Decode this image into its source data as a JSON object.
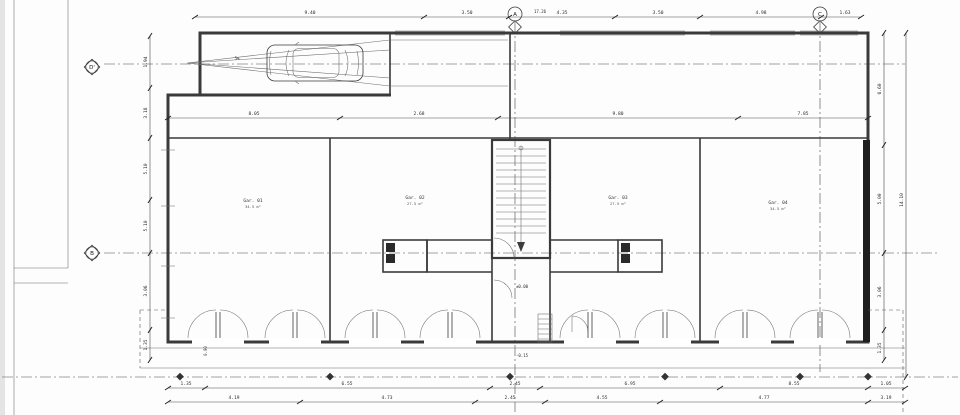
{
  "drawing": {
    "type": "floor-plan",
    "background": "#ffffff",
    "line_color": "#3c3c3c",
    "wall_fill_dark": "#1e1e1e"
  },
  "grid": {
    "a": "A",
    "b": "B",
    "c": "C",
    "d": "D'"
  },
  "annotations": {
    "total_width": "17.26",
    "slope": "5%",
    "level_ground": "±0.00",
    "level_entry": "-0.15",
    "door_width": "0.90"
  },
  "dims": {
    "top": [
      "9.40",
      "3.50",
      "4.35",
      "3.50",
      "4.98",
      "1.63"
    ],
    "mid": [
      "8.05",
      "2.68",
      "9.80",
      "7.85"
    ],
    "left": [
      "1.94",
      "3.18",
      "5.10",
      "5.10",
      "3.06",
      "1.35"
    ],
    "right_inner": [
      "6.60",
      "5.00",
      "3.06",
      "1.35"
    ],
    "right_outer": [
      "14.10"
    ],
    "bottom1": [
      "1.35",
      "6.55",
      "2.45",
      "6.95",
      "8.55",
      "1.05"
    ],
    "bottom2": [
      "4.19",
      "4.73",
      "2.45",
      "4.55",
      "4.77",
      "3.19"
    ]
  },
  "rooms": [
    {
      "name": "Gar. 01",
      "area": "34.5 m²"
    },
    {
      "name": "Gar. 02",
      "area": "27.5 m²"
    },
    {
      "name": "Gar. 03",
      "area": "27.5 m²"
    },
    {
      "name": "Gar. 04",
      "area": "34.5 m²"
    }
  ]
}
